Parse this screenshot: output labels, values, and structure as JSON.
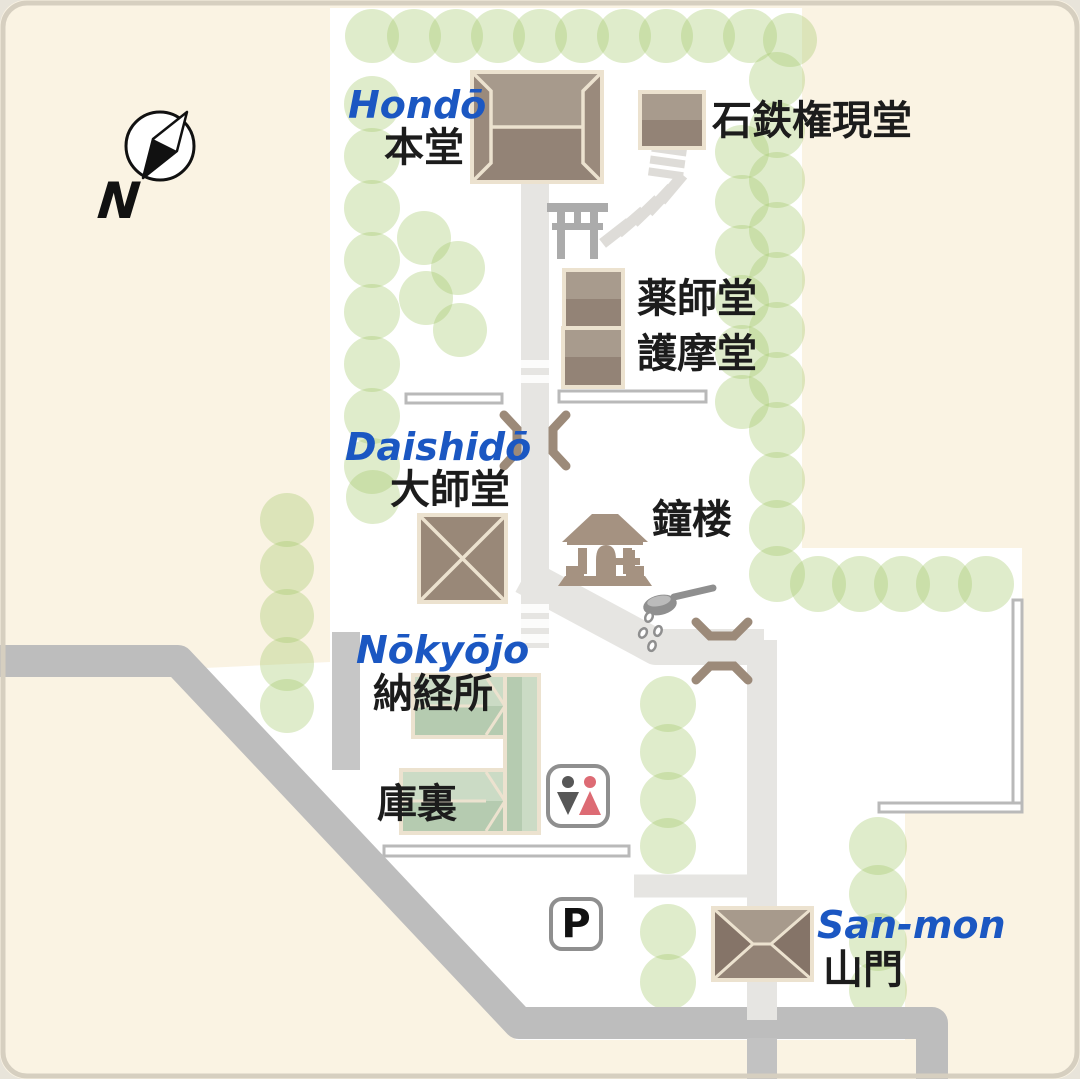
{
  "map_title": "temple precinct map",
  "compass": {
    "letter": "N"
  },
  "parking": {
    "label": "P"
  },
  "labels": {
    "hondo": {
      "romaji": "Hondō",
      "jp": "本堂"
    },
    "ishitetsu_gongendo": {
      "jp": "石鉄権現堂"
    },
    "yakushido": {
      "jp": "薬師堂"
    },
    "gomado": {
      "jp": "護摩堂"
    },
    "daishido": {
      "romaji": "Daishidō",
      "jp": "大師堂"
    },
    "shoro": {
      "jp": "鐘楼"
    },
    "nokyojo": {
      "romaji": "Nōkyōjo",
      "jp": "納経所"
    },
    "kuri": {
      "jp": "庫裏"
    },
    "sanmon": {
      "romaji": "San-mon",
      "jp": "山門"
    }
  },
  "icons": [
    "north-compass-icon",
    "torii-icon",
    "stone-steps-icon",
    "temple-gate-icon",
    "road-gate-icon",
    "bell-tower-icon",
    "water-ladle-icon",
    "toilet-icon",
    "parking-icon"
  ],
  "palette": {
    "background": "#faf3e3",
    "precinct": "#ffffff",
    "road": "#bdbdbd",
    "path": "#e6e5e2",
    "tree": "rgba(164,201,106,0.35)",
    "roof_light": "#a79a8c",
    "roof_dark": "#938376",
    "roof_side": "#9a8a7c",
    "roof_border": "#ece2cf",
    "green_roof_light": "#cbdbc5",
    "green_roof_dark": "#b5cbb0",
    "gate_brown": "#9c8a79",
    "accent_blue": "#1b57c2",
    "torii_gray": "#ababab",
    "ladle_gray": "#8f8f8f",
    "toilet_male": "#575757",
    "toilet_female": "#dd6b74",
    "wall_border": "#b9b9b9",
    "bell_tower_taupe": "#a59281"
  }
}
